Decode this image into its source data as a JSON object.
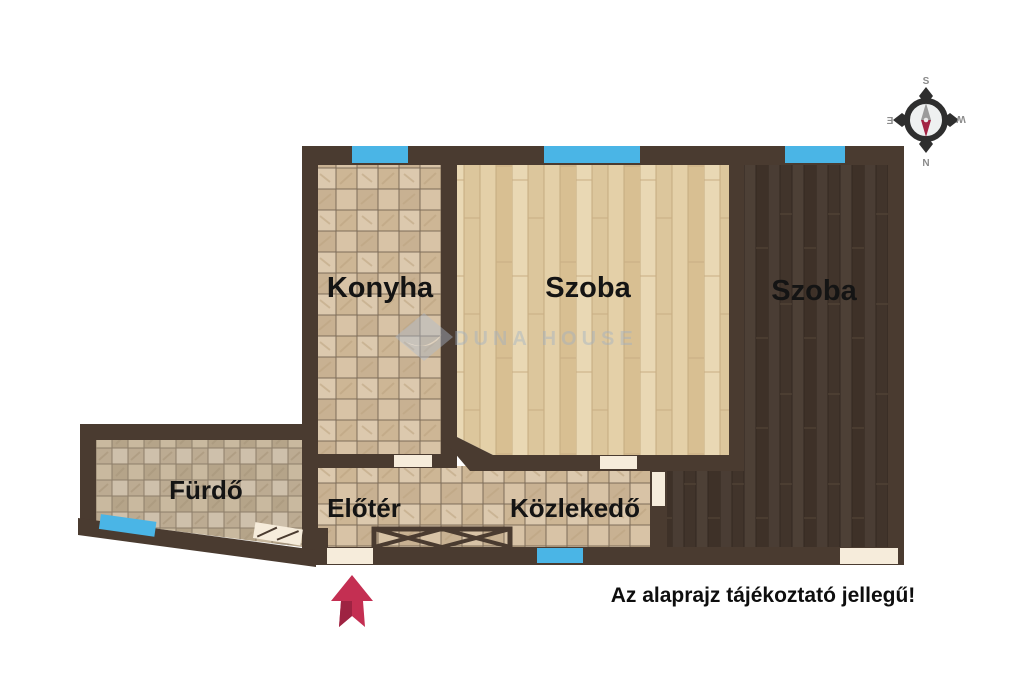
{
  "title": "Alaprajz",
  "rooms": {
    "konyha": {
      "label": "Konyha"
    },
    "szoba_1": {
      "label": "Szoba"
    },
    "szoba_2": {
      "label": "Szoba"
    },
    "furdo": {
      "label": "Fürdő"
    },
    "eloter": {
      "label": "Előtér"
    },
    "kozlekedo": {
      "label": "Közlekedő"
    }
  },
  "disclaimer": "Az alaprajz tájékoztató jellegű!",
  "compass": {
    "top": "S",
    "bottom": "N",
    "left": "E",
    "right": "W"
  },
  "watermark": {
    "text": "DUNA HOUSE"
  },
  "colors": {
    "wall": "#4a3b30",
    "window": "#4ab5e6",
    "door_opening": "#f6ecdb",
    "floor_tile_light": "#d5c1a5",
    "floor_tile_bath": "#c6b8a2",
    "floor_wood_light": "#e7d4ad",
    "floor_wood_dark": "#46382e",
    "entrance_arrow": "#c42f52",
    "entrance_arrow_shade": "#9e2342",
    "compass_needle_north": "#a32343",
    "compass_needle_south": "#9b9b9b",
    "label_text": "#141414"
  }
}
